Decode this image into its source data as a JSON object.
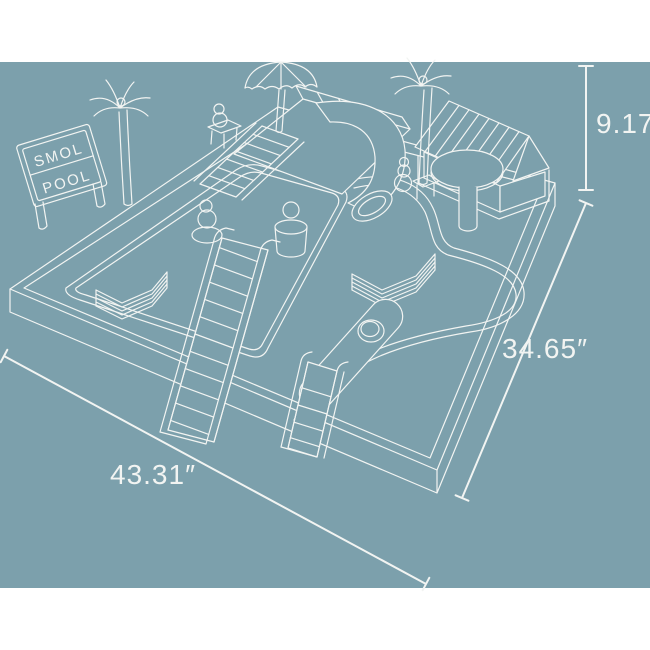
{
  "scene": {
    "title": "SMOL POOL playset dimension drawing",
    "background_color": "#ffffff",
    "panel_color": "#7ca0ac",
    "line_color": "#f2f4f2"
  },
  "sign": {
    "line1": "SMOL",
    "line2": "POOL"
  },
  "dimensions": {
    "height_label": "9.17″",
    "depth_label": "34.65″",
    "width_label": "43.31″"
  }
}
